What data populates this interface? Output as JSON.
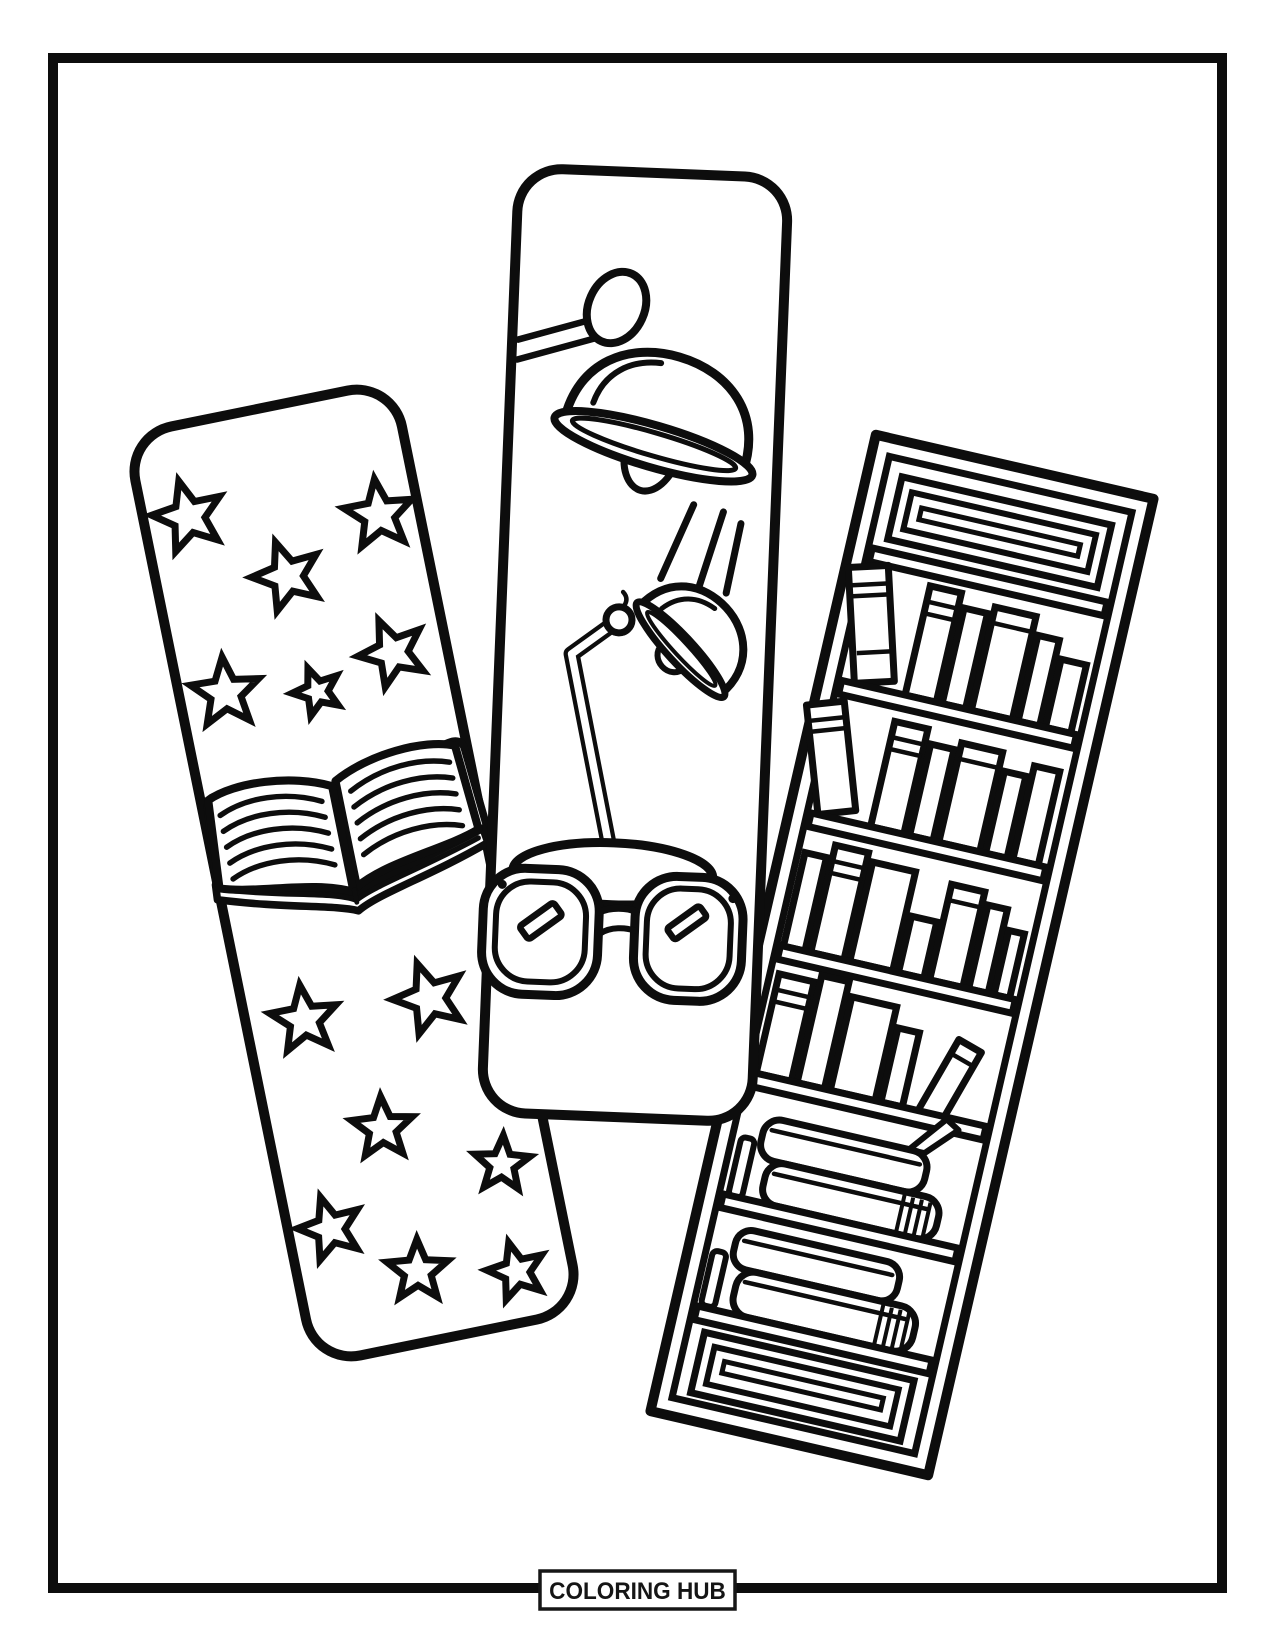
{
  "footer": {
    "label": "COLORING HUB"
  },
  "palette": {
    "ink": "#0d0d0d",
    "paper": "#ffffff"
  },
  "artwork": {
    "description": "Printable coloring page with three overlapping reading-themed bookmarks drawn in black outline on white",
    "bookmarks": [
      {
        "name": "stars-and-open-book",
        "motifs": [
          "stars",
          "open book"
        ],
        "star_count": 13
      },
      {
        "name": "reading-lamps-and-glasses",
        "motifs": [
          "pendant lamp",
          "light rays",
          "desk lamp",
          "eyeglasses"
        ],
        "ray_count": 3
      },
      {
        "name": "bookshelf",
        "motifs": [
          "bookcase",
          "book spines",
          "tilted books",
          "stacked flat books"
        ],
        "shelf_count": 6
      }
    ],
    "icons": [
      "star-icon",
      "open-book-icon",
      "pendant-lamp-icon",
      "desk-lamp-icon",
      "eyeglasses-icon",
      "bookshelf-icon",
      "light-ray-icon"
    ],
    "stars": [
      [
        45,
        92,
        37,
        -4
      ],
      [
        130,
        170,
        36,
        -8
      ],
      [
        232,
        128,
        36,
        4
      ],
      [
        46,
        272,
        36,
        6
      ],
      [
        136,
        289,
        25,
        -10
      ],
      [
        218,
        266,
        35,
        -12
      ],
      [
        58,
        608,
        35,
        4
      ],
      [
        185,
        612,
        37,
        -8
      ],
      [
        113,
        730,
        32,
        8
      ],
      [
        223,
        789,
        29,
        14
      ],
      [
        42,
        818,
        33,
        -6
      ],
      [
        119,
        877,
        32,
        10
      ],
      [
        216,
        897,
        30,
        -4
      ]
    ],
    "light_rays": [
      [
        158,
        405,
        188,
        330
      ],
      [
        196,
        414,
        218,
        336
      ],
      [
        224,
        417,
        236,
        347
      ]
    ],
    "book_lines_per_page": 5
  }
}
